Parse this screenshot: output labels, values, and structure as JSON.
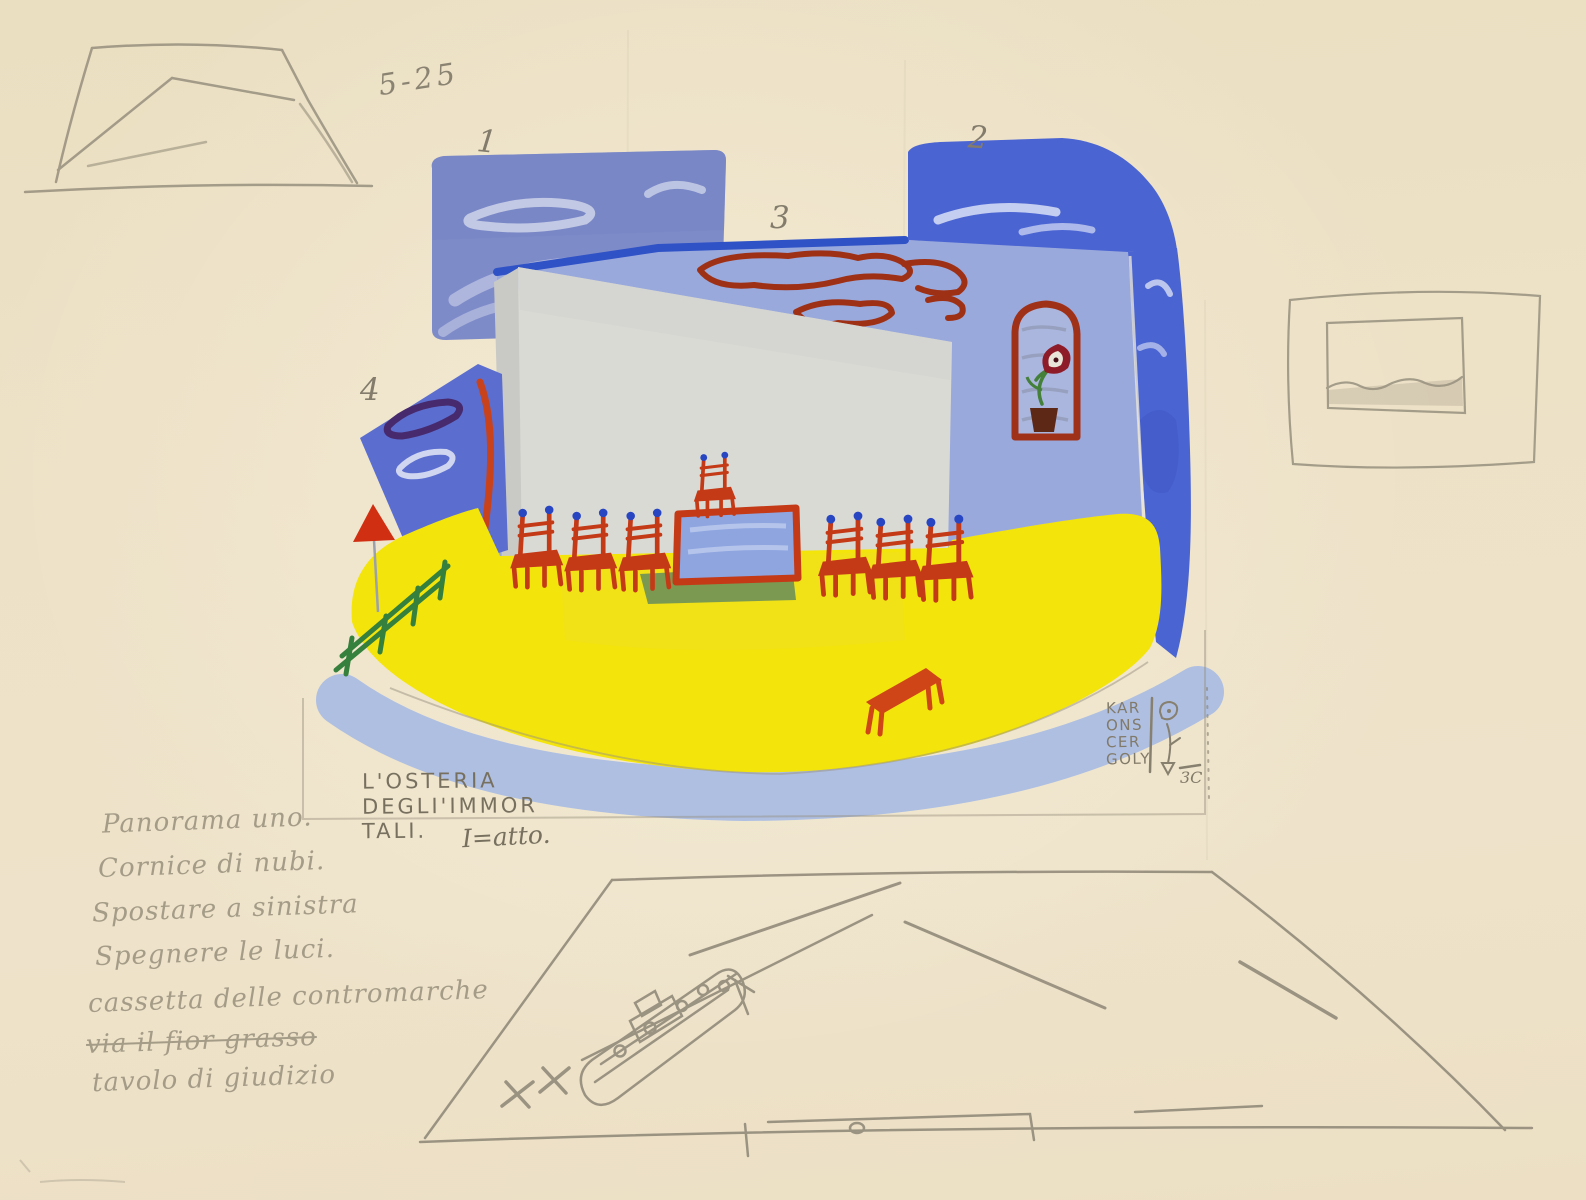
{
  "artwork": {
    "pencil_note_top": "5-25",
    "panel_numbers": {
      "p1": "1",
      "p2": "2",
      "p3": "3",
      "p4": "4"
    },
    "caption": {
      "line1": "L'OSTERIA",
      "line2": "DEGLI'IMMOR",
      "line3": "TALI.",
      "act": "I=atto."
    },
    "signature": {
      "line1": "KAR",
      "line2": "ONS",
      "line3": "CER",
      "line4": "GOLY",
      "mark": "3C"
    },
    "handwritten_notes": [
      {
        "text": "Panorama uno."
      },
      {
        "text": "Cornice di nubi."
      },
      {
        "text": "Spostare a sinistra"
      },
      {
        "text": "Spegnere le luci."
      },
      {
        "text": "cassetta delle contromarche"
      },
      {
        "text": "via il fior grasso"
      },
      {
        "text": "tavolo di giudizio"
      }
    ],
    "colors": {
      "paper": "#ecdfc4",
      "sky_blue_bright": "#4a64d2",
      "sky_blue_medium": "#7e8bc9",
      "wall_blue_light": "#9aa9dc",
      "floor_yellow": "#f3e40c",
      "apron_blue": "#aabde3",
      "furniture_red": "#c43a17",
      "finial_blue": "#2946c2",
      "fence_green": "#35803c",
      "pencil_gray": "#8d8577"
    }
  }
}
